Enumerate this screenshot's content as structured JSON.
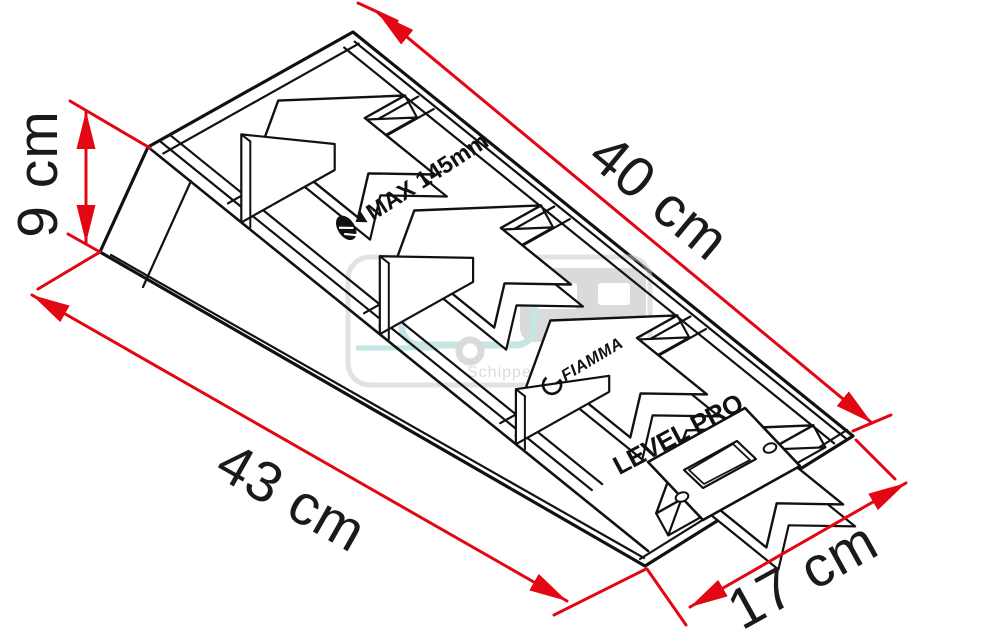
{
  "diagram": {
    "dimensions": {
      "deck_length": {
        "label": "40 cm"
      },
      "rear_height": {
        "label": "9 cm"
      },
      "base_length": {
        "label": "43 cm"
      },
      "entry_width": {
        "label": "17 cm"
      }
    },
    "product_markings": {
      "max_wheel_note": "MAX 145mm",
      "brand": "FIAMMA",
      "model": "LEVEL PRO"
    },
    "watermark": {
      "text": "Schippercaravans"
    },
    "colors": {
      "dimension_red": "#e30613",
      "line_black": "#111111",
      "watermark_gray": "#b9b9b9",
      "watermark_teal": "#8ecfc9",
      "watermark_yellow": "#f2d35c"
    }
  }
}
